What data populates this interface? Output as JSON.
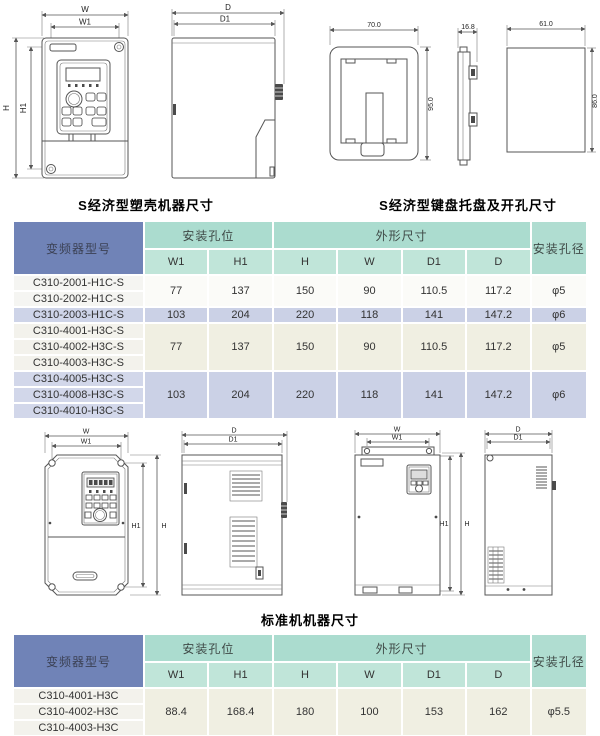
{
  "captions": {
    "plastic": "S经济型塑壳机器尺寸",
    "keypad_tray": "S经济型键盘托盘及开孔尺寸",
    "standard": "标准机机器尺寸"
  },
  "colors": {
    "header_blue": "#7083b7",
    "header_mint": "#abdccf",
    "subheader_mint": "#c0e5d9",
    "row_lavender": "#cbd1e6",
    "row_cream": "#f0efe2",
    "row_white": "#fbfbf8"
  },
  "drawings": {
    "dim_labels": {
      "w": "W",
      "w1": "W1",
      "h": "H",
      "h1": "H1",
      "d": "D",
      "d1": "D1"
    },
    "tray_dims": {
      "width": "70.0",
      "height": "95.0",
      "depth": "16.8",
      "cutout_width": "61.0",
      "cutout_height": "86.0"
    }
  },
  "tables": {
    "headers": {
      "model": "变频器型号",
      "mounting_holes": "安装孔位",
      "outline": "外形尺寸",
      "hole_dia": "安装孔径",
      "w1": "W1",
      "h1": "H1",
      "h": "H",
      "w": "W",
      "d1": "D1",
      "d": "D"
    },
    "economy": {
      "groups": [
        {
          "models": [
            "C310-2001-H1C-S",
            "C310-2002-H1C-S"
          ],
          "w1": "77",
          "h1": "137",
          "h": "150",
          "w": "90",
          "d1": "110.5",
          "d": "117.2",
          "dia": "φ5"
        },
        {
          "models": [
            "C310-2003-H1C-S"
          ],
          "w1": "103",
          "h1": "204",
          "h": "220",
          "w": "118",
          "d1": "141",
          "d": "147.2",
          "dia": "φ6"
        },
        {
          "models": [
            "C310-4001-H3C-S",
            "C310-4002-H3C-S",
            "C310-4003-H3C-S"
          ],
          "w1": "77",
          "h1": "137",
          "h": "150",
          "w": "90",
          "d1": "110.5",
          "d": "117.2",
          "dia": "φ5"
        },
        {
          "models": [
            "C310-4005-H3C-S",
            "C310-4008-H3C-S",
            "C310-4010-H3C-S"
          ],
          "w1": "103",
          "h1": "204",
          "h": "220",
          "w": "118",
          "d1": "141",
          "d": "147.2",
          "dia": "φ6"
        }
      ]
    },
    "standard": {
      "groups": [
        {
          "models": [
            "C310-4001-H3C",
            "C310-4002-H3C",
            "C310-4003-H3C"
          ],
          "w1": "88.4",
          "h1": "168.4",
          "h": "180",
          "w": "100",
          "d1": "153",
          "d": "162",
          "dia": "φ5.5"
        }
      ]
    }
  }
}
